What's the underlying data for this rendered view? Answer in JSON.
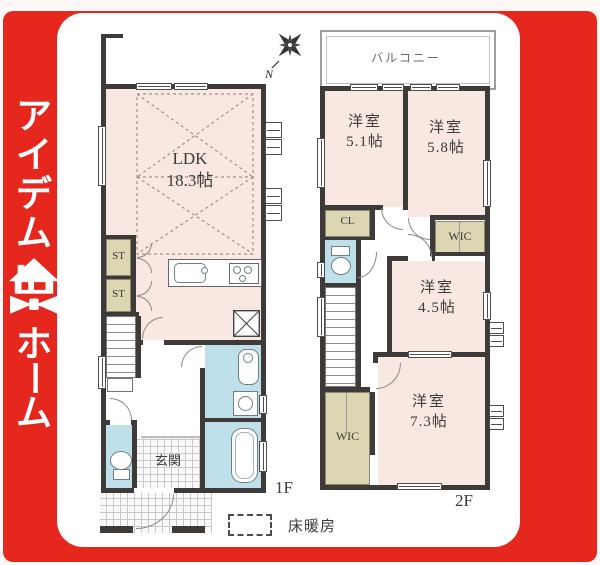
{
  "logo": {
    "top_chars": [
      "ア",
      "イ",
      "デ",
      "ム"
    ],
    "bottom_chars": [
      "ホ",
      "ー",
      "ム"
    ],
    "icon": "house-bowtie-icon"
  },
  "compass": {
    "north": "N",
    "icon": "compass-rose-icon"
  },
  "floor1": {
    "label": "1F",
    "ldk": {
      "name": "LDK",
      "size": "18.3帖"
    },
    "storage": [
      "ST",
      "ST"
    ],
    "entrance": "玄関"
  },
  "floor2": {
    "label": "2F",
    "balcony": "バルコニー",
    "rooms": [
      {
        "name": "洋室",
        "size": "5.1帖"
      },
      {
        "name": "洋室",
        "size": "5.8帖"
      },
      {
        "name": "洋室",
        "size": "4.5帖"
      },
      {
        "name": "洋室",
        "size": "7.3帖"
      }
    ],
    "closet": "CL",
    "wic": [
      "WIC",
      "WIC"
    ]
  },
  "legend": {
    "label": "床暖房"
  },
  "colors": {
    "brand_red": "#e6271e",
    "room_pink": "#f9e7e1",
    "storage_beige": "#dcd7b2",
    "wet_blue": "#bfdfea",
    "wall_dark": "#3e3a37"
  }
}
